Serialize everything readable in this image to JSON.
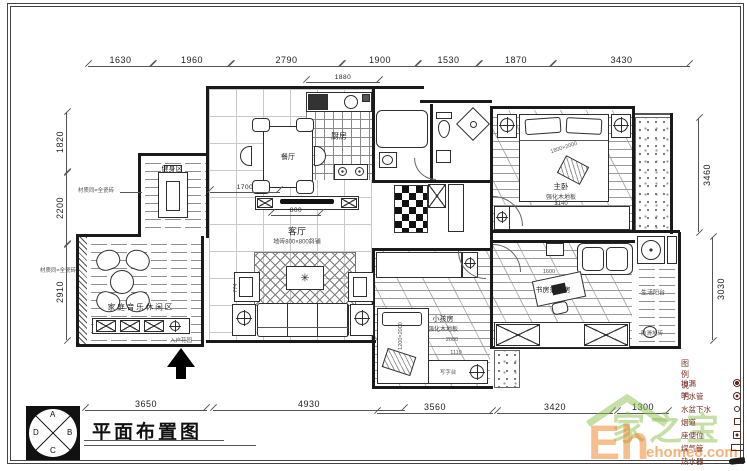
{
  "title_block": {
    "title": "平面布置图"
  },
  "compass": {
    "top": "A",
    "right": "B",
    "bottom": "C",
    "left": "D"
  },
  "dims": {
    "top": [
      "1630",
      "1960",
      "2790",
      "1900",
      "1530",
      "1870",
      "3430"
    ],
    "bottom": [
      "3650",
      "4930",
      "3560",
      "3420",
      "1300"
    ],
    "left": [
      "1820",
      "2200",
      "2910"
    ],
    "right": [
      "3460",
      "3030"
    ],
    "inner": {
      "kitchen": "1880",
      "dining": "1700",
      "tv": "800",
      "living": "774",
      "master": "3140",
      "study": "1600",
      "kids_w": "1110",
      "kids_h": "2080"
    }
  },
  "rooms": {
    "dining": {
      "label": "餐厅"
    },
    "kitchen": {
      "label": "厨房"
    },
    "master": {
      "label": "主卧",
      "floor": "强化木地板",
      "bed": "1800×2000"
    },
    "living": {
      "label": "客厅",
      "floor": "地砖800×800斜铺"
    },
    "fitness": {
      "label": "健身区"
    },
    "music": {
      "label": "家庭音乐休闲区"
    },
    "kids": {
      "label": "小孩房",
      "floor": "强化木地板",
      "bed": "1200×2000",
      "desk": "写字台"
    },
    "study": {
      "label": "书房兼客房"
    },
    "laundry": {
      "label": "生活阳台",
      "floor": "防滑地砖"
    }
  },
  "notes": {
    "left_upper": "材质同=全瓷砖",
    "left_lower": "材质同=全瓷砖",
    "entry": "入户花园"
  },
  "legend": {
    "heading": "图例说明:",
    "items": [
      {
        "name": "地漏",
        "icon": "floor-drain"
      },
      {
        "name": "下水管",
        "icon": "drain-pipe"
      },
      {
        "name": "水盆下水",
        "icon": "basin-drain"
      },
      {
        "name": "烟道",
        "icon": "flue"
      },
      {
        "name": "座便位",
        "icon": "toilet-position"
      },
      {
        "name": "煤气管",
        "icon": "gas-pipe"
      },
      {
        "name": "热水器",
        "icon": "water-heater"
      }
    ]
  },
  "watermark": {
    "brand_cn": "家之宝",
    "brand_en": "Eh",
    "domain": "ehome8.com"
  },
  "colors": {
    "line": "#1a1a1a",
    "dim": "#555555",
    "legend_text": "#7a3428",
    "wm_green": "#8cc152",
    "wm_orange": "#f07f1f"
  }
}
